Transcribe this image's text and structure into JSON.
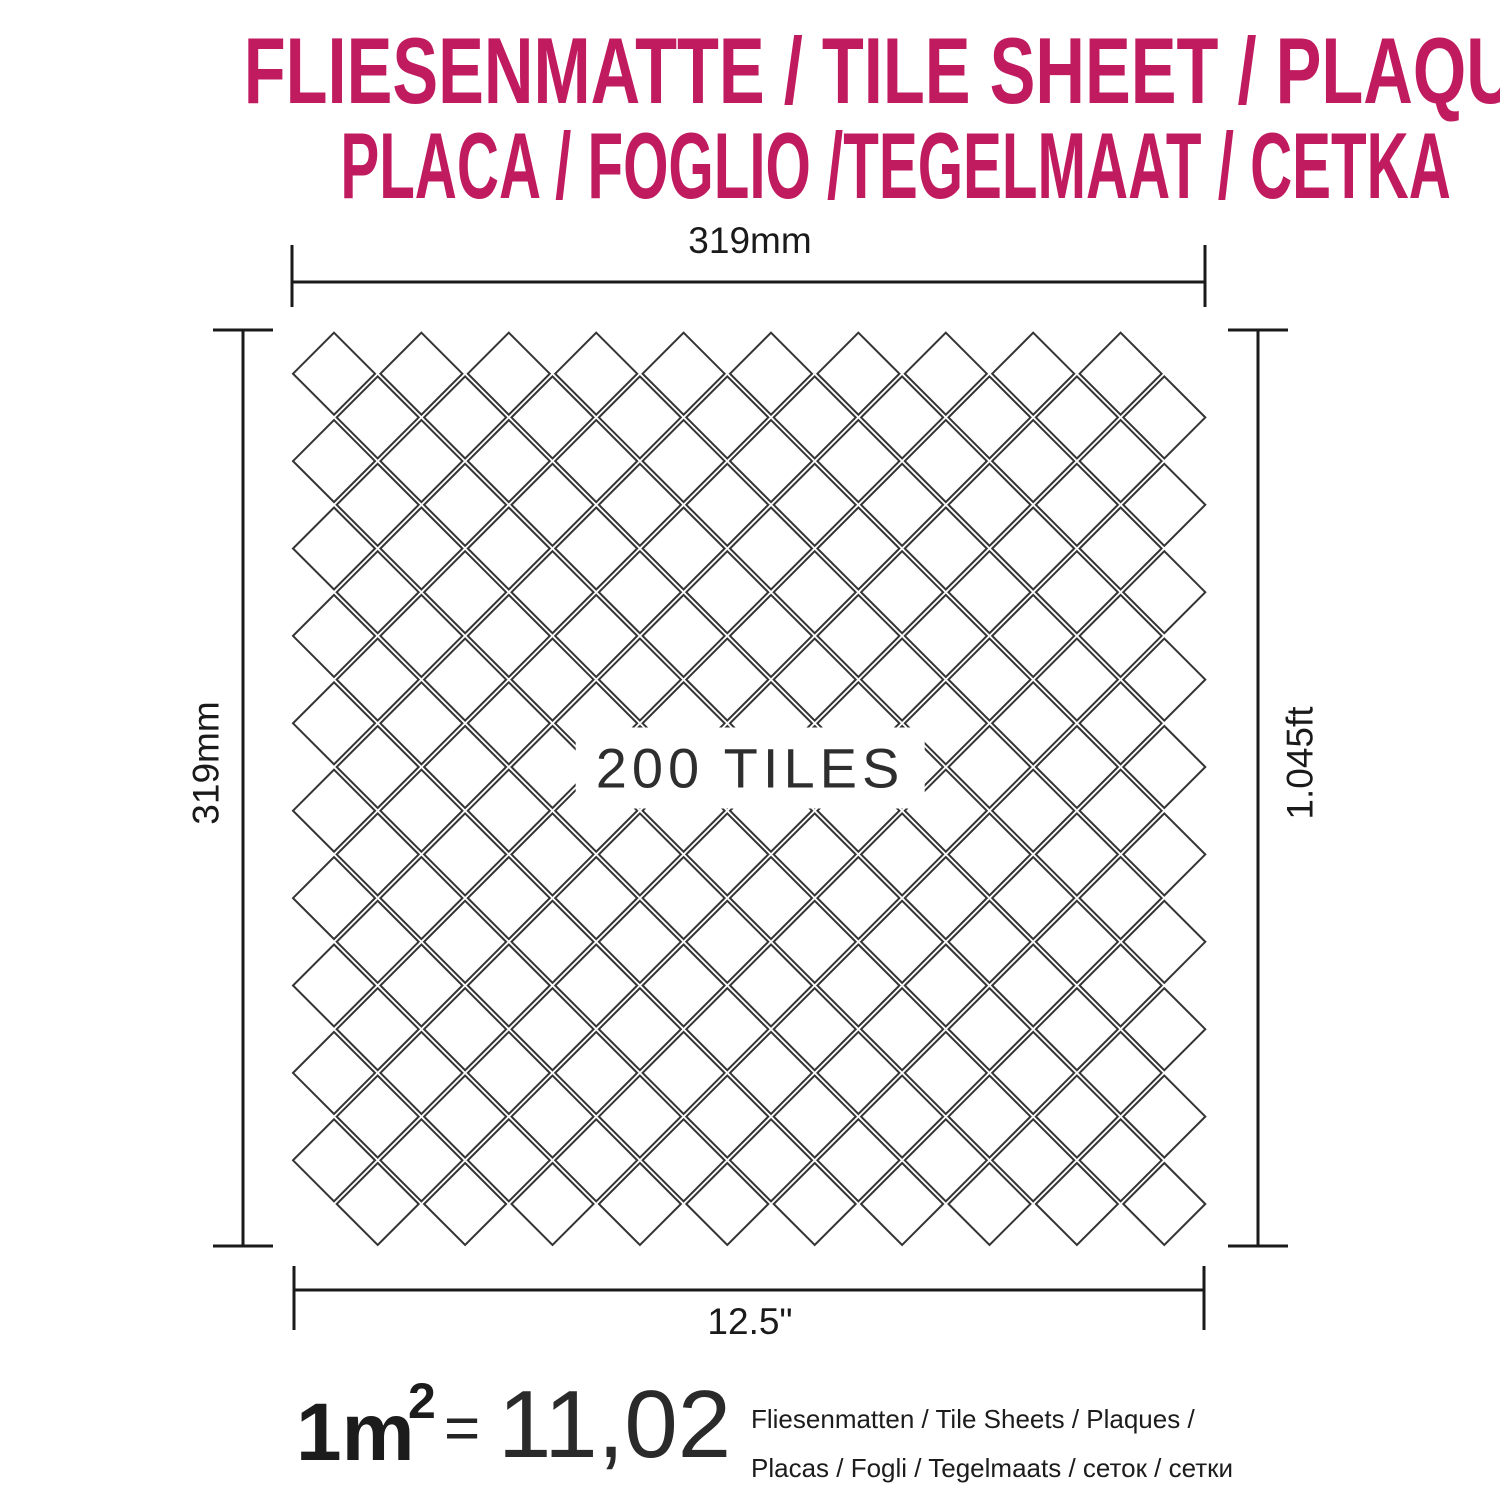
{
  "page": {
    "background": "#ffffff"
  },
  "title": {
    "line1": "FLIESENMATTE / TILE SHEET / PLAQUE",
    "line2": "PLACA / FOGLIO /TEGELMAAT / CETKA",
    "color": "#c11b60"
  },
  "sheet": {
    "tiles_label": "200 TILES",
    "grid": {
      "rows": 20,
      "cols": 10,
      "pitch": 87.4,
      "tile_radius": 41,
      "origin_x": 334,
      "origin_y": 373.7,
      "line_color": "#343434",
      "stroke_width": 2
    }
  },
  "dimensions": {
    "top": "319mm",
    "left": "319mm",
    "right": "1.045ft",
    "bottom": "12.5\"",
    "line_color": "#1a1a1a"
  },
  "formula": {
    "lhs": "1m",
    "exponent": "2",
    "equals": "=",
    "value": "11,02",
    "units_line1": "Fliesenmatten / Tile Sheets / Plaques /",
    "units_line2": "Placas / Fogli / Tegelmaats / сеток / сетки"
  }
}
